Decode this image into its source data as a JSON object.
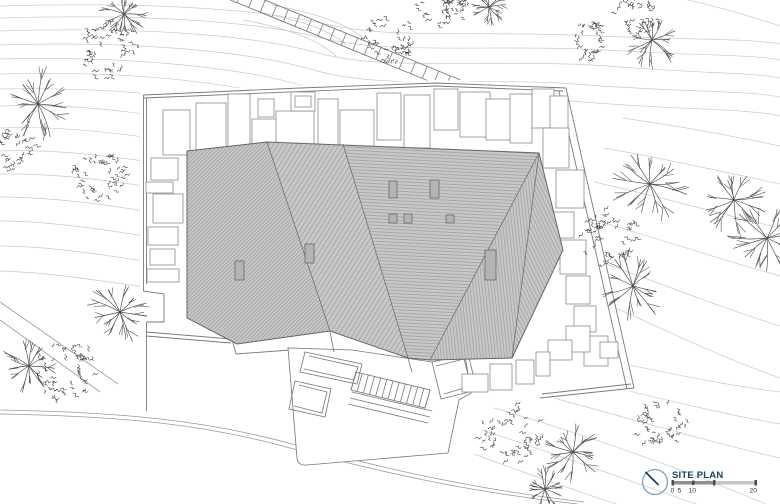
{
  "titleblock": {
    "label": "SITE PLAN",
    "scale_labels": [
      "0",
      "5",
      "10",
      "20"
    ]
  },
  "icons": {
    "compass": "compass-north-icon"
  },
  "colors": {
    "contour": "#c9c9c9",
    "line": "#7a7a7a",
    "road": "#9a9a9a",
    "roof_fill": "#c8c8c8",
    "hatch": "#8f8f8f",
    "ridge": "#707070",
    "skylight": "#b4b4b4",
    "tree": "#4a4a4a",
    "leaf": "#383838",
    "compass_blue": "#7e9fc4",
    "navy": "#1d4166",
    "bar_dark": "#8f8f8f",
    "bar_light": "#c6c6c6",
    "tick": "#4c4c4c"
  },
  "contours": [
    "M0,6 C140,2 255,8 325,24 C395,40 480,30 600,36 C690,40 745,38 780,44",
    "M0,18 C135,14 250,20 322,38 C392,55 485,44 605,50 C700,56 748,54 780,60",
    "M0,31 C128,27 246,33 318,53 C388,72 490,58 608,66 C705,74 750,72 780,78",
    "M0,45 C120,41 240,49 314,70 C382,90 475,77 575,84 C670,92 745,90 780,97",
    "M0,59 C112,56 235,65 308,87 C375,107 460,95 560,100 C665,110 748,108 780,116",
    "M0,74 C105,71 200,78 280,96 C330,108 390,106 440,104",
    "M0,89 C100,87 195,95 275,112 C320,122 380,120 430,118",
    "M0,106 C50,104 100,108 144,114",
    "M0,128 C50,126 100,131 144,137",
    "M0,151 C48,149 100,155 144,161",
    "M0,174 C46,173 98,179 144,186",
    "M0,197 C44,197 96,203 144,211",
    "M0,221 C44,221 94,228 144,236",
    "M0,246 C42,246 92,253 144,261",
    "M0,271 C42,272 90,279 144,287",
    "M622,118 C680,126 742,138 780,146",
    "M604,148 C672,160 734,174 780,184",
    "M594,182 C662,197 728,216 780,228",
    "M588,218 C656,238 722,260 780,276",
    "M584,256 C652,280 716,306 780,326",
    "M588,296 C654,324 712,354 780,378",
    "M542,348 C622,362 700,382 780,392",
    "M524,366 C612,386 700,410 780,424",
    "M508,386 C602,410 692,438 780,458",
    "M494,408 C590,436 680,468 766,504",
    "M482,430 C568,458 638,484 696,504",
    "M474,454 C538,478 586,494 616,504",
    "M688,0 C724,8 756,18 780,26",
    "M258,12 C300,20 332,31 346,45",
    "M272,5 C316,13 350,25 364,39",
    "M243,20 C288,28 321,41 337,57"
  ],
  "roads": [
    "M0,410 C120,412 205,420 292,444 C382,468 472,489 584,502",
    "M0,414 C120,416 204,424 290,448 C380,472 468,492 578,504",
    "M0,302 L118,384",
    "M0,320 L100,392"
  ],
  "driveway": {
    "x1": 228,
    "y1": -8,
    "x2": 458,
    "y2": 86,
    "half": 6.5,
    "step": 12.5
  },
  "platform": {
    "mask": "140,92 436,80 566,86 636,390 540,400 470,392 462,462 300,460 288,350 140,345",
    "lines": [
      "M143.5,95 L300,88 L436,83 L566,88",
      "M143.5,98 L436,86 L563,91",
      "M566,88 L634,388",
      "M559,91 L627,389",
      "M143.5,95 L143.5,284",
      "M146.5,98 L146.5,284",
      "M143.5,284 L143.5,291 L164,294 L164,322 L146.5,322",
      "M146.5,322 L146.5,411",
      "M634,388 L540,398",
      "M631,384 L542,394",
      "M146,332 L232,339 L236,354 L290,350",
      "M146,336 L231,343"
    ]
  },
  "paving": [
    [
      163,
      110,
      27,
      45
    ],
    [
      196,
      103,
      30,
      50
    ],
    [
      228,
      94,
      22,
      61
    ],
    [
      252,
      119,
      26,
      38
    ],
    [
      258,
      99,
      16,
      18
    ],
    [
      276,
      111,
      38,
      45
    ],
    [
      291,
      92,
      24,
      19
    ],
    [
      295,
      96,
      16,
      11
    ],
    [
      318,
      99,
      20,
      58
    ],
    [
      340,
      110,
      34,
      42
    ],
    [
      377,
      93,
      24,
      47
    ],
    [
      404,
      95,
      26,
      53
    ],
    [
      434,
      89,
      24,
      41
    ],
    [
      460,
      92,
      30,
      45
    ],
    [
      486,
      99,
      26,
      41
    ],
    [
      510,
      94,
      22,
      49
    ],
    [
      532,
      89,
      22,
      39
    ],
    [
      550,
      96,
      18,
      42
    ],
    [
      543,
      128,
      26,
      40
    ],
    [
      556,
      170,
      28,
      38
    ],
    [
      552,
      212,
      22,
      26
    ],
    [
      560,
      240,
      26,
      34
    ],
    [
      566,
      276,
      24,
      28
    ],
    [
      574,
      306,
      22,
      26
    ],
    [
      584,
      336,
      24,
      30
    ],
    [
      600,
      342,
      18,
      16
    ],
    [
      566,
      326,
      24,
      26
    ],
    [
      548,
      340,
      24,
      20
    ],
    [
      536,
      352,
      14,
      24
    ],
    [
      516,
      360,
      18,
      24
    ],
    [
      490,
      364,
      22,
      26
    ],
    [
      462,
      374,
      26,
      18
    ],
    [
      151,
      158,
      27,
      22
    ],
    [
      146,
      182,
      27,
      11
    ],
    [
      153,
      194,
      30,
      29
    ],
    [
      148,
      227,
      30,
      18
    ],
    [
      150,
      249,
      25,
      16
    ],
    [
      147,
      269,
      32,
      13
    ]
  ],
  "terrace": {
    "paths": [
      "M288,348 L297,458 Q298,466 307,465 L448,453 L459,400 L471,393 L465,355 L432,362 L352,350 Z",
      "M305,352 L362,364 L357,384 L300,372 Z",
      "M309,356 L358,367 L354,380 L304,369",
      "M295,381 L331,389 L325,417 L289,409 Z",
      "M299,385 L327,392 L322,413 L294,406",
      "M352,392 L432,411",
      "M350,398 L430,417",
      "M348,404 L428,423",
      "M432,362 L468,354 L477,390 L441,399 Z",
      "M436,366 L464,359 L471,386 L444,394",
      "M330,332 L334,352",
      "M408,358 L412,372"
    ],
    "stairs": {
      "x": 356,
      "y": 372,
      "dx": 74,
      "dy": 18,
      "px": -5,
      "py": 18,
      "n": 12
    }
  },
  "roof": {
    "outline": "187,151 267,142 539,153 563,250 512,358 430,360 408,358 330,331 237,344 187,318",
    "facets": [
      {
        "points": "187,151 267,142 330,331 237,344 187,318",
        "pattern": "hA"
      },
      {
        "points": "267,142 343,144 408,358 330,331",
        "pattern": "hB"
      },
      {
        "points": "343,144 539,153 430,360 408,358",
        "pattern": "hC"
      },
      {
        "points": "539,153 512,358 430,360",
        "pattern": "hD"
      },
      {
        "points": "539,153 563,250 512,358",
        "pattern": "hE"
      }
    ],
    "ridges": [
      "M267,142 L330,331",
      "M343,144 L408,358",
      "M539,153 L430,360",
      "M539,153 L512,358"
    ],
    "skylights": [
      [
        235,
        261,
        9,
        19
      ],
      [
        305,
        244,
        9,
        19
      ],
      [
        389,
        181,
        8,
        17
      ],
      [
        430,
        180,
        9,
        18
      ],
      [
        389,
        214,
        8,
        9
      ],
      [
        404,
        214,
        8,
        9
      ],
      [
        446,
        215,
        8,
        8
      ],
      [
        485,
        250,
        11,
        30
      ]
    ]
  },
  "trees": {
    "branch": [
      [
        38,
        104,
        36
      ],
      [
        124,
        14,
        24
      ],
      [
        652,
        40,
        28
      ],
      [
        650,
        184,
        40
      ],
      [
        734,
        200,
        34
      ],
      [
        767,
        238,
        42
      ],
      [
        633,
        286,
        36
      ],
      [
        120,
        312,
        34
      ],
      [
        29,
        366,
        28
      ],
      [
        573,
        452,
        32
      ],
      [
        545,
        489,
        24
      ],
      [
        489,
        7,
        20
      ]
    ],
    "leafy": [
      [
        108,
        52,
        30
      ],
      [
        99,
        174,
        27
      ],
      [
        12,
        148,
        22
      ],
      [
        390,
        38,
        26
      ],
      [
        436,
        8,
        20
      ],
      [
        456,
        4,
        14
      ],
      [
        590,
        40,
        20
      ],
      [
        637,
        14,
        22
      ],
      [
        612,
        238,
        30
      ],
      [
        66,
        372,
        32
      ],
      [
        512,
        436,
        31
      ],
      [
        661,
        421,
        26
      ]
    ]
  }
}
